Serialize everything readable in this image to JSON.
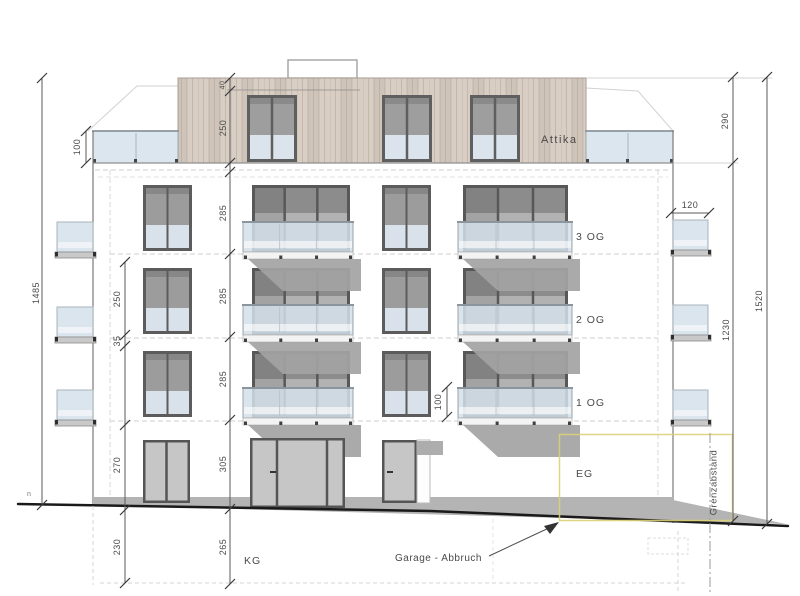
{
  "labels": {
    "attika": "Attika",
    "floor3": "3 OG",
    "floor2": "2 OG",
    "floor1": "1 OG",
    "eg": "EG",
    "kg": "KG",
    "garage": "Garage - Abbruch",
    "grenzabstand": "Grenzabstand",
    "level_marker": "n"
  },
  "dimensions": {
    "left_total": "1485",
    "parapet_height": "100",
    "left_chain": [
      "250",
      "35",
      "270",
      "230"
    ],
    "center_chain": [
      "40",
      "250",
      "285",
      "285",
      "285",
      "305",
      "265"
    ],
    "balcony_rail_height": "100",
    "side_balcony_width": "120",
    "attic_height": "290",
    "upper_floors_height": "1230",
    "total_height": "1520"
  },
  "colors": {
    "wood": "#d8cec4",
    "glass_blue": "#d9e3ec",
    "window_gray": "#b2b2b2",
    "shadow": "#a3a3a3",
    "plinth": "#b4b4b4",
    "dimension_text": "#4a4a4a",
    "highlight_yellow": "#e6dc96",
    "ground_line": "#1a1a1a"
  }
}
